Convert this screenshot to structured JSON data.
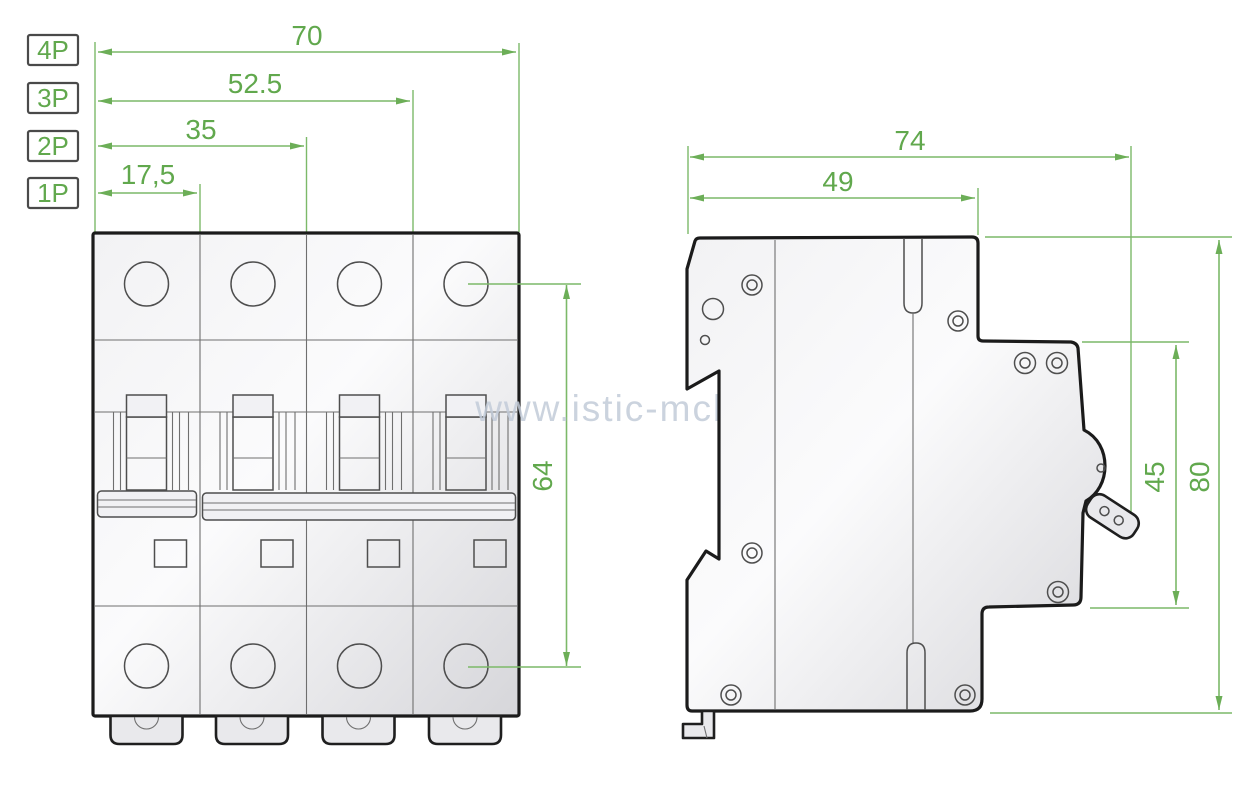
{
  "watermark": "www.istic-mcb.sk",
  "front_view": {
    "pole_rows": [
      {
        "label": "4P",
        "dim": "70"
      },
      {
        "label": "3P",
        "dim": "52.5"
      },
      {
        "label": "2P",
        "dim": "35"
      },
      {
        "label": "1P",
        "dim": "17,5"
      }
    ],
    "terminal_span_dim": "64"
  },
  "side_view": {
    "overall_depth_dim": "74",
    "upper_depth_dim": "49",
    "front_face_height_dim": "45",
    "overall_height_dim": "80"
  },
  "colors": {
    "dimension_text": "#61a84d",
    "dimension_line": "#7cb969",
    "outline": "#1b1b1b",
    "watermark": "#c3ccd9",
    "body_fill_light": "#fbfbfc",
    "body_fill_dark": "#d6d6da"
  }
}
